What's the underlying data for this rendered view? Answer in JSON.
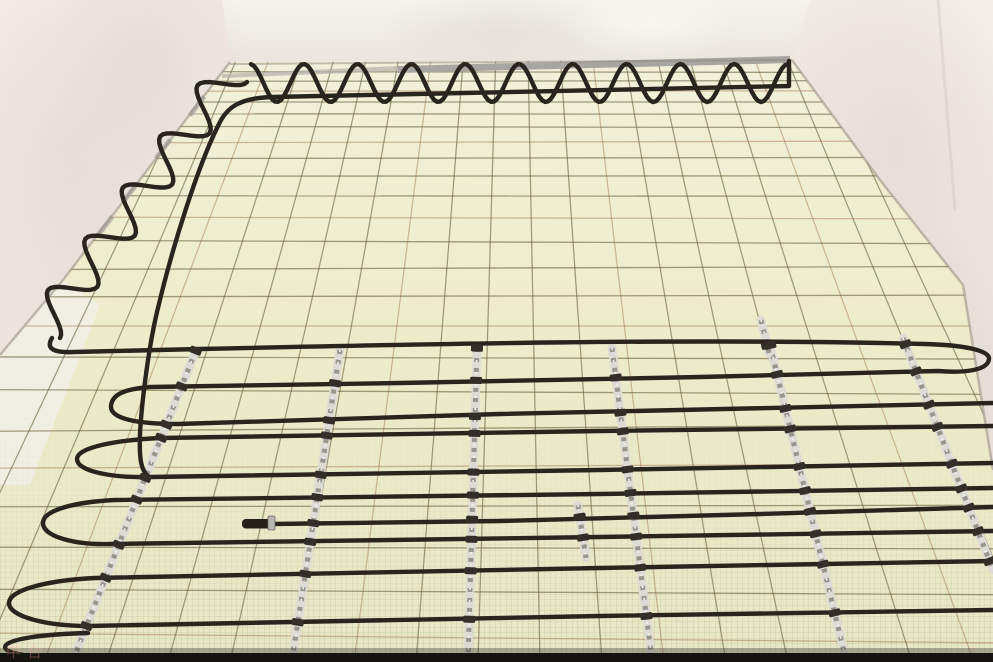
{
  "meta": {
    "description": "Photo of an unfinished room with electric underfloor heating: black heating cable laid in serpentine loops over pale yellow insulation boards covered by a welded wire mesh, with galvanized fixing rails and clamps; bare plaster walls around",
    "width": 993,
    "height": 662
  },
  "watermark": {
    "text": "中合",
    "style": "color:rgba(255,160,155,0.38)"
  },
  "scene": {
    "colors": {
      "back_wall_top": "#f6f3ed",
      "back_wall_bottom": "#e7e3db",
      "left_wall_top": "#f3ece7",
      "left_wall_bottom": "#ece1db",
      "right_wall_top": "#f4efe9",
      "right_wall_bottom": "#e7dfd8",
      "floor_top": "#f2f0da",
      "floor_mid": "#edecca",
      "floor_bottom": "#e7e7c5",
      "pale_patch": "#f1efe6",
      "mesh": "rgba(105,95,62,0.60)",
      "mesh_rust": "rgba(150,95,55,0.40)",
      "fine_mesh": "rgba(115,108,80,0.50)",
      "cable": "#2a241e",
      "cable_end": "#241f1a",
      "rail_base": "#dcdbd6",
      "rail_speckle": "#98958d",
      "rail_glint": "#f4f3f0",
      "clamp": "#332e27",
      "end_clamp": "#b9b7b2",
      "strip_main": "#a8a6a2",
      "strip_faint": "#b3b0ab",
      "strip_frag": "#aeaca8",
      "seam": "rgba(150,140,128,0.55)",
      "seam_back": "rgba(140,135,125,0.5)",
      "bottom_band": "#15130f",
      "bottom_shadow": "rgba(50,48,36,0.35)",
      "mottle_warm": "rgba(210,198,190,0.28)",
      "mottle_gray": "rgba(208,204,196,0.33)",
      "mottle_light": "rgba(255,255,252,0.5)"
    },
    "geometry": {
      "back_wall": [
        [
          222,
          0
        ],
        [
          810,
          0
        ],
        [
          792,
          60
        ],
        [
          230,
          62
        ]
      ],
      "left_wall": [
        [
          0,
          0
        ],
        [
          222,
          0
        ],
        [
          230,
          62
        ],
        [
          63,
          280
        ],
        [
          0,
          355
        ]
      ],
      "right_wall": [
        [
          810,
          0
        ],
        [
          993,
          0
        ],
        [
          993,
          475
        ],
        [
          963,
          285
        ],
        [
          880,
          180
        ],
        [
          792,
          60
        ]
      ],
      "floor": [
        [
          230,
          62
        ],
        [
          792,
          60
        ],
        [
          880,
          180
        ],
        [
          963,
          285
        ],
        [
          993,
          475
        ],
        [
          993,
          662
        ],
        [
          0,
          662
        ],
        [
          0,
          355
        ],
        [
          63,
          280
        ]
      ],
      "pale_patch": [
        [
          63,
          280
        ],
        [
          100,
          305
        ],
        [
          30,
          485
        ],
        [
          0,
          485
        ],
        [
          0,
          355
        ]
      ],
      "left_seam": [
        [
          230,
          62
        ],
        [
          63,
          280
        ],
        [
          0,
          355
        ]
      ],
      "right_seam": [
        [
          792,
          60
        ],
        [
          880,
          180
        ],
        [
          963,
          285
        ],
        [
          993,
          470
        ]
      ],
      "back_seam": [
        [
          230,
          64
        ],
        [
          792,
          60
        ]
      ],
      "strip_main": [
        [
          398,
          66
        ],
        [
          790,
          56
        ],
        [
          790,
          63
        ],
        [
          398,
          73
        ]
      ],
      "strip_faint": [
        [
          222,
          74
        ],
        [
          398,
          66
        ],
        [
          398,
          71
        ],
        [
          222,
          78
        ]
      ],
      "strip_fragments": [
        [
          197,
          106
        ],
        [
          163,
          149
        ],
        [
          130,
          193
        ],
        [
          105,
          226
        ]
      ],
      "strip_fragment_angle": -52.5,
      "mottles": [
        {
          "cx": 70,
          "cy": 150,
          "rx": 130,
          "ry": 210,
          "fill": "warm"
        },
        {
          "cx": 150,
          "cy": 60,
          "rx": 100,
          "ry": 120,
          "fill": "gray"
        },
        {
          "cx": 500,
          "cy": 30,
          "rx": 120,
          "ry": 42,
          "fill": "gray"
        },
        {
          "cx": 650,
          "cy": 24,
          "rx": 90,
          "ry": 34,
          "fill": "light"
        },
        {
          "cx": 900,
          "cy": 140,
          "rx": 130,
          "ry": 220,
          "fill": "warm"
        },
        {
          "cx": 935,
          "cy": 360,
          "rx": 85,
          "ry": 130,
          "fill": "gray"
        }
      ],
      "wall_crease": [
        [
          938,
          0
        ],
        [
          955,
          210
        ]
      ]
    },
    "grid": {
      "vp": [
        515,
        -600
      ],
      "cols": {
        "start": -80,
        "step": 62,
        "count": 20,
        "top_y": 60
      },
      "rows": [
        72,
        81,
        91,
        102,
        114,
        127,
        142,
        158,
        176,
        196,
        218,
        242,
        268,
        296,
        326,
        358,
        392,
        428,
        466,
        506,
        548,
        592,
        638
      ],
      "fine_mesh_cell": 5.5,
      "fine_mesh_area": [
        0,
        380,
        993,
        282
      ],
      "fade": {
        "y1": 390,
        "y2": 650
      }
    },
    "cable": {
      "width": 4.4,
      "top_wave": {
        "x1": 788,
        "x2": 250,
        "mid": 83,
        "amp": 19,
        "period": 53.8
      },
      "left_wave": {
        "p1": [
          247,
          82
        ],
        "p2": [
          60,
          338
        ],
        "amp": 38,
        "periods": 5
      },
      "paths": [
        {
          "name": "serpentine-run-a",
          "d": "M 52 338 C 46 348 52 353 74 352 L 200 349 C 420 344 700 338 925 344 C 962 345 990 350 989 359 C 988 371 962 373 938 371 L 700 377 400 383 150 387 C 125 389 112 394 111 406 C 110 419 138 424 178 424 L 500 414 993 403"
        },
        {
          "name": "serpentine-run-b",
          "d": "M 993 426 L 600 431 160 438 C 118 440 77 447 77 459 C 77 472 115 478 150 477 L 600 470 993 463"
        },
        {
          "name": "serpentine-run-c",
          "d": "M 993 488 L 600 494 115 500 C 75 502 43 510 43 523 C 43 537 76 545 110 544 L 600 537 993 531"
        },
        {
          "name": "serpentine-run-d",
          "d": "M 993 561 L 600 568 95 578 C 52 580 9 589 9 603 C 9 617 48 626 88 626 L 600 616 993 610"
        },
        {
          "name": "serpentine-run-e",
          "d": "M 88 633 C 45 634 5 639 5 647 C 5 655 42 659 80 658 L 460 661"
        },
        {
          "name": "perimeter-cable",
          "d": "M 789 61 L 789 86 C 700 89 450 93 272 97 C 240 98 227 107 219 124 C 198 165 172 248 157 312 C 147 355 141 412 140 434 C 139 459 141 471 149 477"
        },
        {
          "name": "cable-to-end",
          "d": "M 273 524 L 500 521 760 514 993 507"
        }
      ],
      "end_piece": {
        "x": 242,
        "y": 519,
        "w": 32,
        "h": 9.5
      },
      "end_clamp": {
        "x": 268,
        "y": 516,
        "w": 7,
        "h": 14
      }
    },
    "rails": {
      "width": 8.5,
      "segments": [
        [
          196,
          350,
          73,
          660
        ],
        [
          340,
          350,
          292,
          660
        ],
        [
          477,
          348,
          468,
          660
        ],
        [
          612,
          348,
          652,
          660
        ],
        [
          770,
          345,
          846,
          660
        ],
        [
          903,
          338,
          993,
          570
        ],
        [
          578,
          505,
          586,
          558
        ],
        [
          761,
          320,
          769,
          353
        ]
      ],
      "clamp_lines": [
        [
          52,
          352,
          925,
          344
        ],
        [
          938,
          371,
          150,
          387
        ],
        [
          150,
          425,
          993,
          403
        ],
        [
          150,
          438,
          993,
          426
        ],
        [
          140,
          478,
          993,
          463
        ],
        [
          110,
          500,
          993,
          488
        ],
        [
          107,
          545,
          993,
          531
        ],
        [
          90,
          578,
          993,
          561
        ],
        [
          85,
          626,
          993,
          610
        ],
        [
          273,
          524,
          993,
          507
        ]
      ]
    },
    "bottom_band": {
      "y": 653,
      "h": 9,
      "shadow_y": 648,
      "shadow_h": 5
    }
  }
}
